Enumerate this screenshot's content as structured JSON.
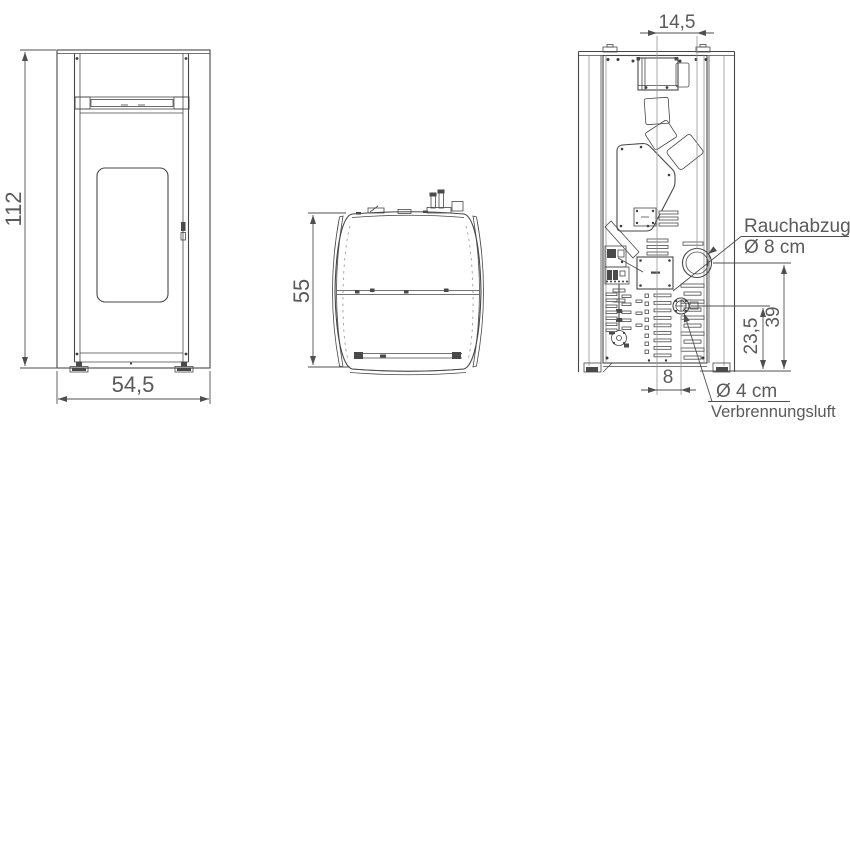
{
  "drawing": {
    "front_view": {
      "height": "112",
      "width": "54,5"
    },
    "side_view": {
      "depth": "55"
    },
    "rear_view": {
      "flue_center_offset": "14,5",
      "flue_label": "Rauchabzug",
      "flue_diameter": "Ø 8 cm",
      "flue_height": "39",
      "air_height": "23,5",
      "air_center_offset": "8",
      "air_diameter": "Ø 4 cm",
      "air_label": "Verbrennungsluft"
    },
    "colors": {
      "line": "#474747",
      "line_light": "#969696",
      "text": "#5a5a5a",
      "background": "#ffffff"
    }
  }
}
